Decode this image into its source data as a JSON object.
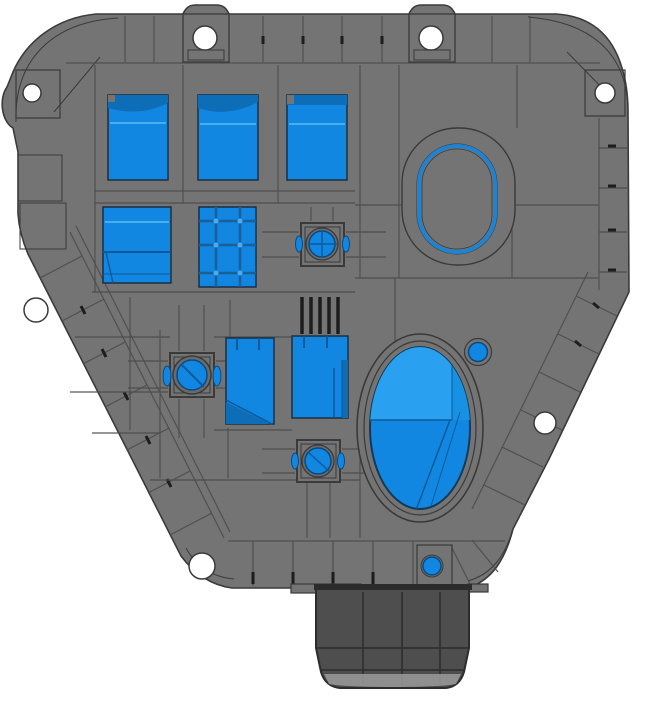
{
  "scene": {
    "description": "3D CAD render, top view of a gray molded housing cover with blue through-openings and a bottom cylindrical boss",
    "background": "white",
    "text_visible": "none"
  },
  "colors": {
    "background": "#ffffff",
    "body_gray": "#747474",
    "body_gray_mid": "#6b6b6b",
    "outline_dark": "#3a3a3a",
    "panel_line": "#4e4e4e",
    "rib_dark": "#1d1d1d",
    "cutout_blue": "#1287e2",
    "cutout_blue_light": "#2aa1f0",
    "cutout_blue_dark": "#0d6db6",
    "cutout_blue_deep": "#0a5a9b",
    "grid_blue_line": "#1b5f97",
    "ring_blue": "#1f83d2",
    "cylinder_gray": "#4e4e4e",
    "cylinder_dark": "#2c2c2c",
    "cylinder_rim": "#9b9b9b",
    "hole_white": "#ffffff"
  },
  "features": {
    "mounting_holes": 7,
    "window_cutouts": 7,
    "screw_bosses": 3,
    "small_blue_holes": 2,
    "oval_opening": 1,
    "oval_recess": 1,
    "bottom_cylinder": 1,
    "edge_rib_bands": 5
  }
}
